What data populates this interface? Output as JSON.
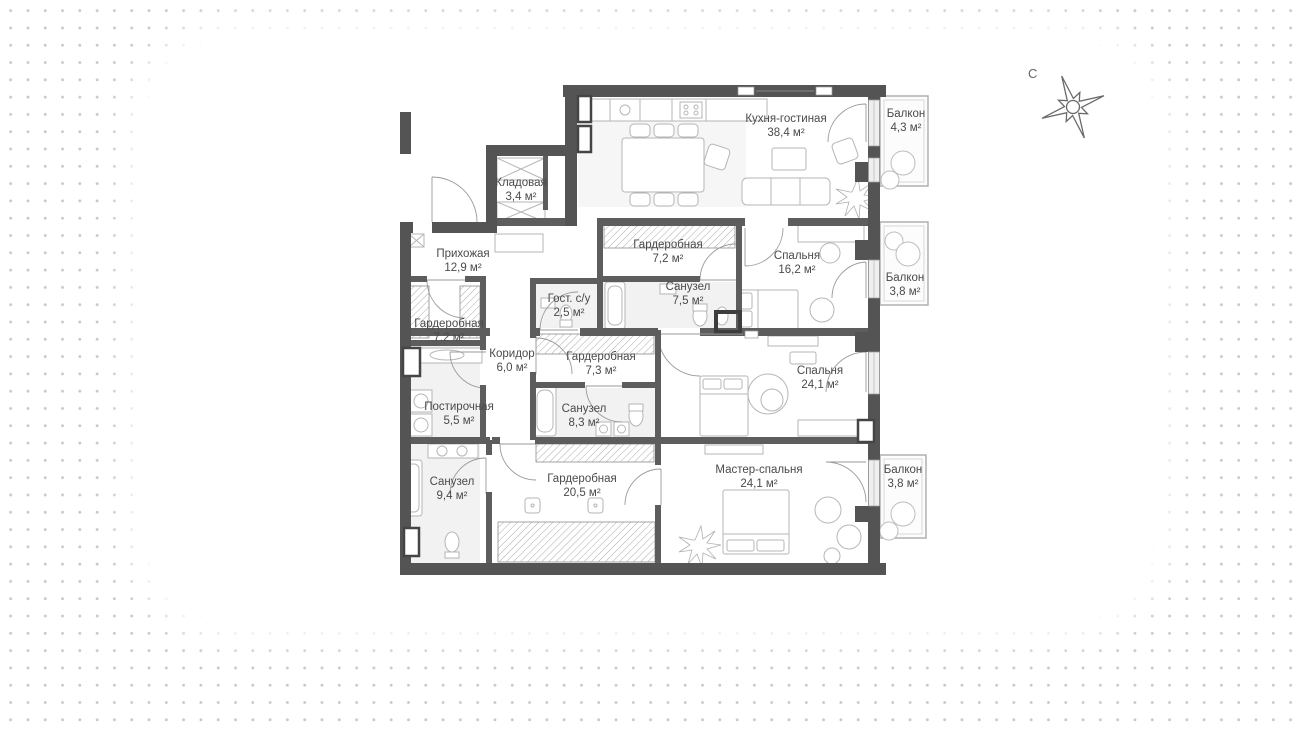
{
  "title": "Apartment floor plan",
  "compass": {
    "north_label": "С"
  },
  "colors": {
    "exterior_wall": "#545454",
    "interior_wall": "#5d5d5d",
    "furniture_line": "#b6b6b6",
    "glazing_fill": "#efefef",
    "dot_grid": "#c8c8c8",
    "label_text": "#4a4a4a"
  },
  "plan": {
    "rooms": [
      {
        "id": "kitchen-living",
        "name": "Кухня-гостиная",
        "area": "38,4 м²"
      },
      {
        "id": "balcony-top",
        "name": "Балкон",
        "area": "4,3 м²"
      },
      {
        "id": "storage",
        "name": "Кладовая",
        "area": "3,4 м²"
      },
      {
        "id": "entry-hall",
        "name": "Прихожая",
        "area": "12,9 м²"
      },
      {
        "id": "wardrobe-top",
        "name": "Гардеробная",
        "area": "7,2 м²"
      },
      {
        "id": "bedroom-16",
        "name": "Спальня",
        "area": "16,2 м²"
      },
      {
        "id": "balcony-mid",
        "name": "Балкон",
        "area": "3,8 м²"
      },
      {
        "id": "guest-wc",
        "name": "Гост. с/у",
        "area": "2,5 м²"
      },
      {
        "id": "bathroom-75",
        "name": "Санузел",
        "area": "7,5 м²"
      },
      {
        "id": "wardrobe-left",
        "name": "Гардеробная",
        "area": "7,2 м²"
      },
      {
        "id": "corridor",
        "name": "Коридор",
        "area": "6,0 м²"
      },
      {
        "id": "wardrobe-73",
        "name": "Гардеробная",
        "area": "7,3 м²"
      },
      {
        "id": "bedroom-24",
        "name": "Спальня",
        "area": "24,1 м²"
      },
      {
        "id": "laundry",
        "name": "Постирочная",
        "area": "5,5 м²"
      },
      {
        "id": "bathroom-83",
        "name": "Санузел",
        "area": "8,3 м²"
      },
      {
        "id": "master-bedroom",
        "name": "Мастер-спальня",
        "area": "24,1 м²"
      },
      {
        "id": "balcony-bottom",
        "name": "Балкон",
        "area": "3,8 м²"
      },
      {
        "id": "bathroom-94",
        "name": "Санузел",
        "area": "9,4 м²"
      },
      {
        "id": "wardrobe-205",
        "name": "Гардеробная",
        "area": "20,5 м²"
      }
    ]
  }
}
